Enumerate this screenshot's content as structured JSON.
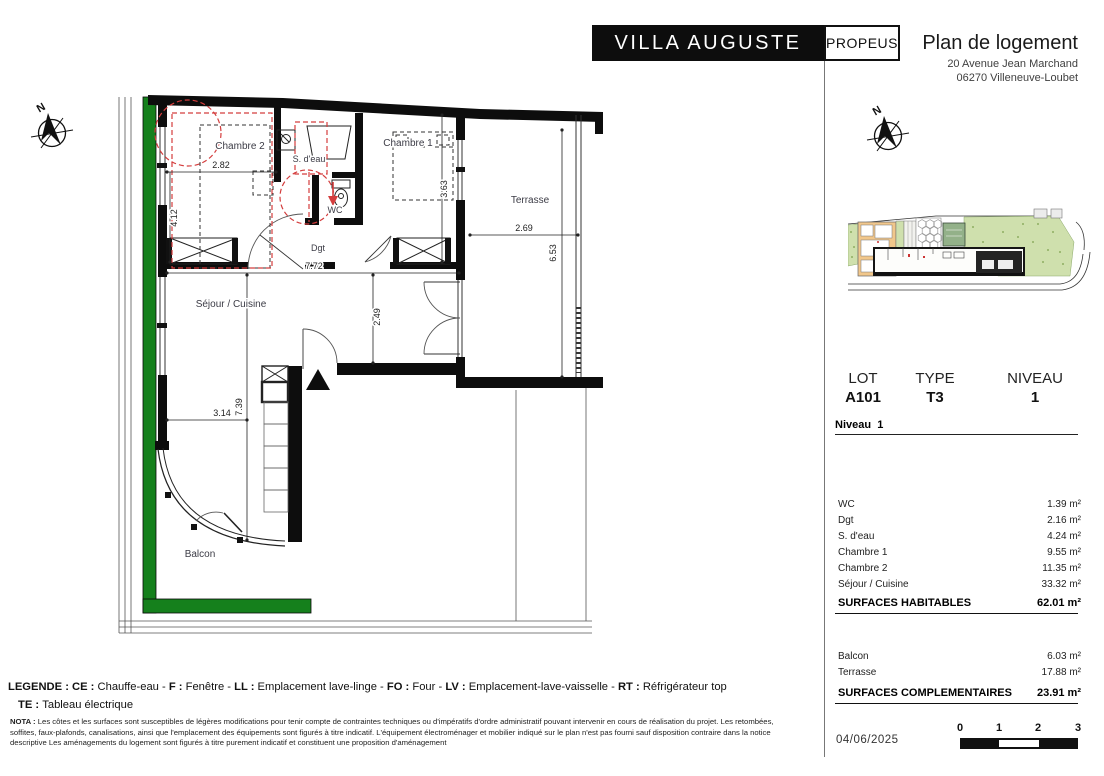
{
  "header": {
    "project": "VILLA AUGUSTE",
    "brand": "PROPEUS",
    "doc_title": "Plan de logement",
    "address_line1": "20 Avenue Jean Marchand",
    "address_line2": "06270 Villeneuve-Loubet"
  },
  "unit": {
    "lot_label": "LOT",
    "lot_value": "A101",
    "type_label": "TYPE",
    "type_value": "T3",
    "niveau_label": "NIVEAU",
    "niveau_value": "1",
    "level_label": "Niveau",
    "level_value": "1"
  },
  "surfaces": {
    "rows": [
      {
        "label": "WC",
        "value": "1.39 m²"
      },
      {
        "label": "Dgt",
        "value": "2.16 m²"
      },
      {
        "label": "S. d'eau",
        "value": "4.24 m²"
      },
      {
        "label": "Chambre 1",
        "value": "9.55 m²"
      },
      {
        "label": "Chambre 2",
        "value": "11.35 m²"
      },
      {
        "label": "Séjour / Cuisine",
        "value": "33.32 m²"
      }
    ],
    "total_label": "SURFACES HABITABLES",
    "total_value": "62.01 m²"
  },
  "complementaires": {
    "rows": [
      {
        "label": "Balcon",
        "value": "6.03 m²"
      },
      {
        "label": "Terrasse",
        "value": "17.88 m²"
      }
    ],
    "total_label": "SURFACES COMPLEMENTAIRES",
    "total_value": "23.91 m²"
  },
  "footer": {
    "date": "04/06/2025",
    "scale_ticks": [
      "0",
      "1",
      "2",
      "3"
    ]
  },
  "legend": {
    "line1": [
      {
        "b": true,
        "t": "LEGENDE :   "
      },
      {
        "b": true,
        "t": "CE : "
      },
      {
        "b": false,
        "t": "Chauffe-eau - "
      },
      {
        "b": true,
        "t": "F : "
      },
      {
        "b": false,
        "t": "Fenêtre - "
      },
      {
        "b": true,
        "t": "LL : "
      },
      {
        "b": false,
        "t": "Emplacement lave-linge - "
      },
      {
        "b": true,
        "t": "FO : "
      },
      {
        "b": false,
        "t": "Four - "
      },
      {
        "b": true,
        "t": "LV : "
      },
      {
        "b": false,
        "t": "Emplacement-lave-vaisselle - "
      },
      {
        "b": true,
        "t": "RT : "
      },
      {
        "b": false,
        "t": "Réfrigérateur top"
      }
    ],
    "line2": [
      {
        "b": true,
        "t": "TE : "
      },
      {
        "b": false,
        "t": "Tableau électrique"
      }
    ]
  },
  "nota": {
    "segments": [
      {
        "b": true,
        "t": "NOTA : "
      },
      {
        "b": false,
        "t": "Les côtes et les surfaces sont susceptibles de légères modifications pour tenir compte de contraintes techniques ou d'impératifs d'ordre administratif pouvant intervenir en cours de réalisation du projet. Les retombées, soffites, faux-plafonds, canalisations, ainsi que l'emplacement des équipements sont figurés à titre indicatif. L'équipement électroménager et mobilier indiqué sur le plan n'est pas fourni sauf disposition contraire dans la notice descriptive Les aménagements du logement sont figurés à titre purement indicatif et constituent une proposition d'aménagement"
      }
    ]
  },
  "plan": {
    "north": "N",
    "rooms": {
      "chambre2": "Chambre 2",
      "sdeau": "S. d'eau",
      "wc": "WC",
      "chambre1": "Chambre 1",
      "terrasse": "Terrasse",
      "dgt": "Dgt",
      "sejour": "Séjour / Cuisine",
      "balcon": "Balcon"
    },
    "dims": {
      "d282": "2.82",
      "d412": "4.12",
      "d772": "7.72",
      "d363": "3.63",
      "d269": "2.69",
      "d653": "6.53",
      "d249": "2.49",
      "d739": "7.39",
      "d314": "3.14"
    }
  },
  "colors": {
    "accent_green": "#15801c",
    "red_markup": "#d43d3d",
    "site_orange": "#f1c78b",
    "site_green": "#cfe0ad"
  }
}
